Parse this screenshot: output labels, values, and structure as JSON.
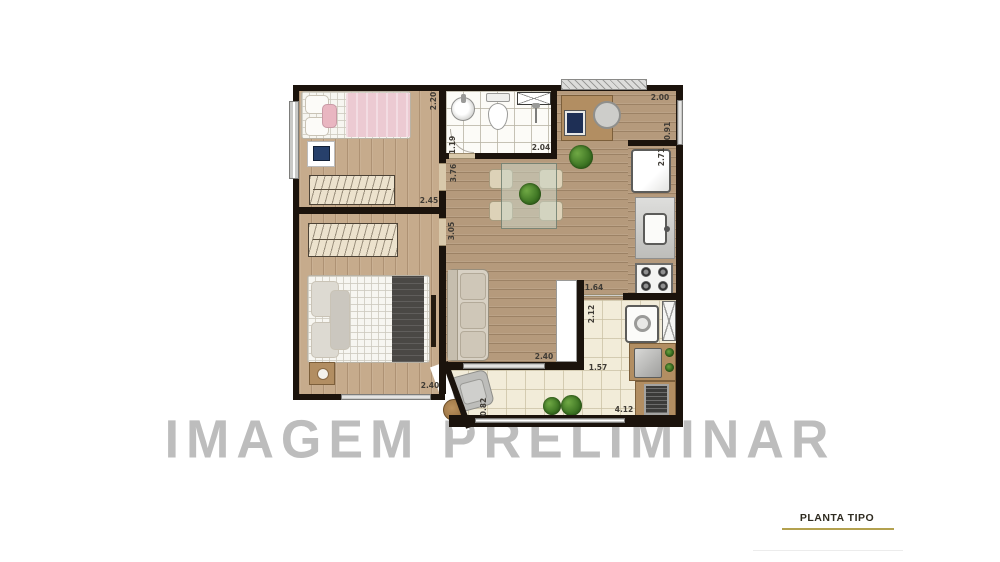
{
  "watermark": {
    "text": "IMAGEM PRELIMINAR"
  },
  "caption": {
    "text": "PLANTA TIPO"
  },
  "colors": {
    "wall": "#1b130c",
    "watermark_gray": "#bdbdbd",
    "caption_underline_gold": "#b3a14f",
    "wood_floor_living": "#b59a7c",
    "wood_floor_bedroom": "#c6ab8c",
    "tile_service": "#f2ecd9",
    "tile_bathroom": "#fcfbf7"
  },
  "plan": {
    "type": "apartment-floor-plan",
    "dimensions_m": {
      "bedroom1_depth": "2.20",
      "bedroom1_width": "2.45",
      "bathroom_width": "1.19",
      "bathroom_length": "2.04",
      "hall_depth": "3.76",
      "bedroom2_depth": "3.05",
      "bedroom2_width": "2.40",
      "office_width": "2.00",
      "office_depth": "0.91",
      "kitchen_depth": "2.71",
      "service_opening": "1.64",
      "service_depth": "2.12",
      "living_opening": "2.40",
      "service_width": "1.57",
      "balcony_depth": "0.82",
      "terrace_length": "4.12"
    }
  }
}
